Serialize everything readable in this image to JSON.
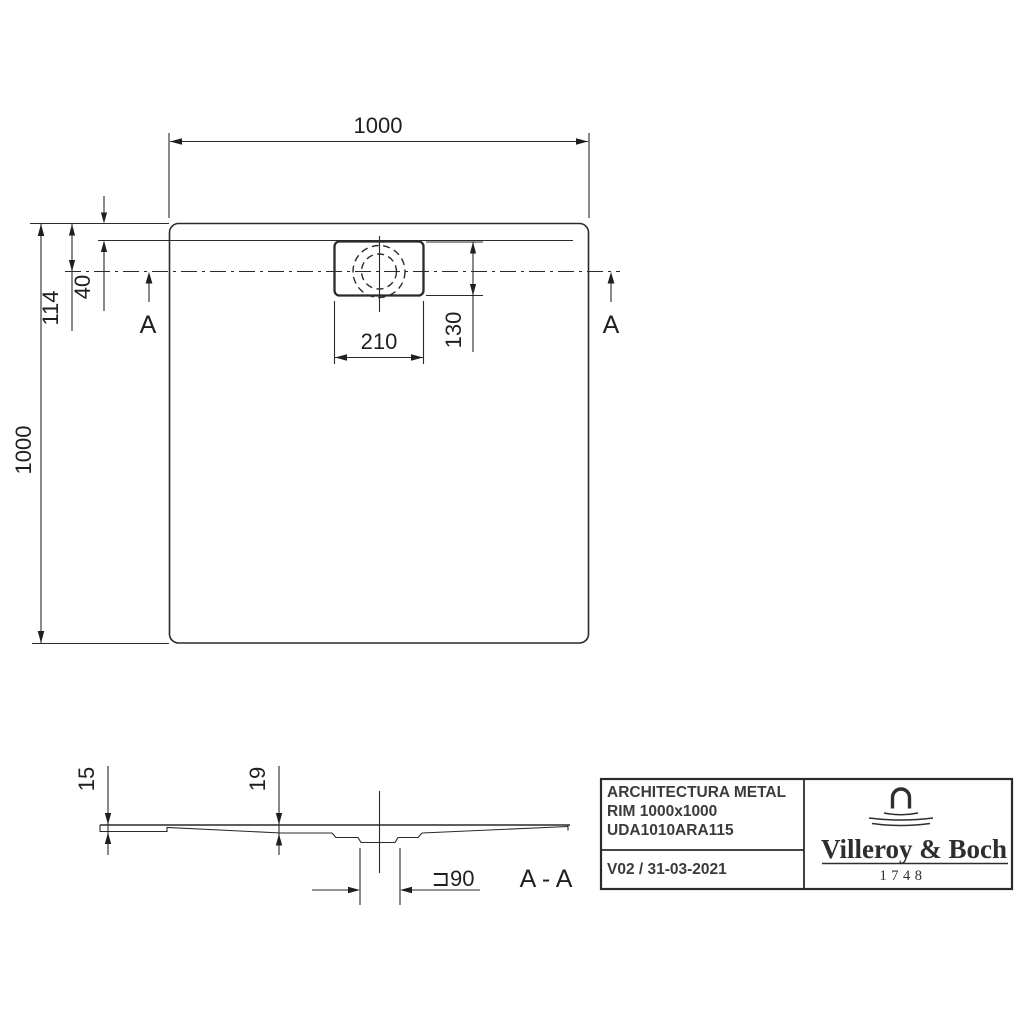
{
  "background_color": "#ffffff",
  "line_color": "#2a2a2a",
  "top_view": {
    "width_label": "1000",
    "height_label": "1000",
    "drain_center_offset_label": "114",
    "rim_depth_label": "40",
    "drain_width_label": "210",
    "drain_depth_label": "130",
    "section_marker_left": "A",
    "section_marker_right": "A"
  },
  "section_view": {
    "edge_height_label": "15",
    "drain_area_height_label": "19",
    "drain_diameter_label": "⊐90",
    "section_title": "A - A"
  },
  "title_block": {
    "product_name": "ARCHITECTURA METAL",
    "product_variant": "RIM 1000x1000",
    "article_number": "UDA1010ARA115",
    "revision_date": "V02 / 31-03-2021",
    "brand_name": "Villeroy & Boch",
    "brand_year": "1748",
    "text_color": "#3b3b3b"
  }
}
